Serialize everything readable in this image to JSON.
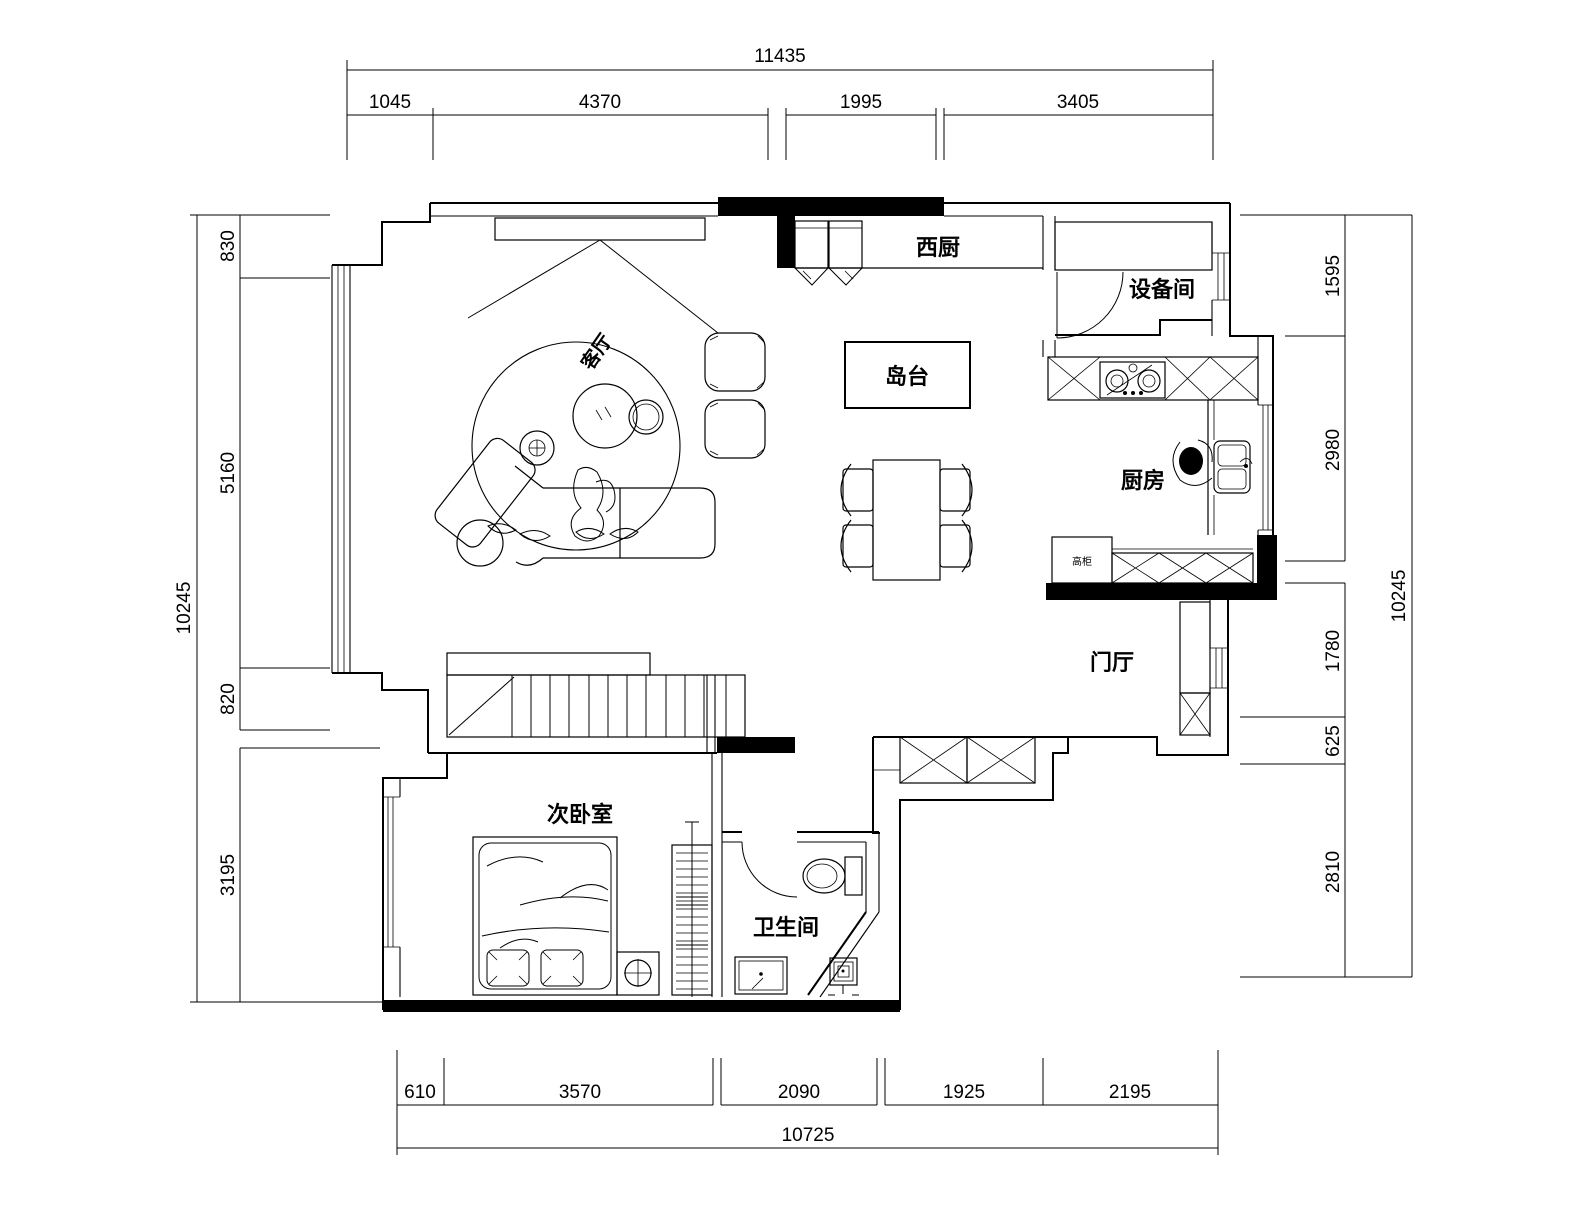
{
  "rooms": {
    "west_kitchen": "西厨",
    "equipment_room": "设备间",
    "island": "岛台",
    "kitchen": "厨房",
    "foyer": "门厅",
    "living_room": "客厅",
    "second_bedroom": "次卧室",
    "bathroom": "卫生间",
    "tall_cabinet": "高柜"
  },
  "dimensions": {
    "top": {
      "total": "11435",
      "segments": [
        "1045",
        "4370",
        "1995",
        "3405"
      ]
    },
    "left": {
      "total": "10245",
      "segments": [
        "830",
        "5160",
        "820",
        "3195"
      ]
    },
    "right": {
      "total": "10245",
      "segments": [
        "1595",
        "2980",
        "1780",
        "625",
        "2810"
      ]
    },
    "bottom": {
      "total": "10725",
      "segments": [
        "610",
        "3570",
        "2090",
        "1925",
        "2195"
      ]
    }
  },
  "colors": {
    "line": "#000000",
    "background": "#ffffff"
  }
}
